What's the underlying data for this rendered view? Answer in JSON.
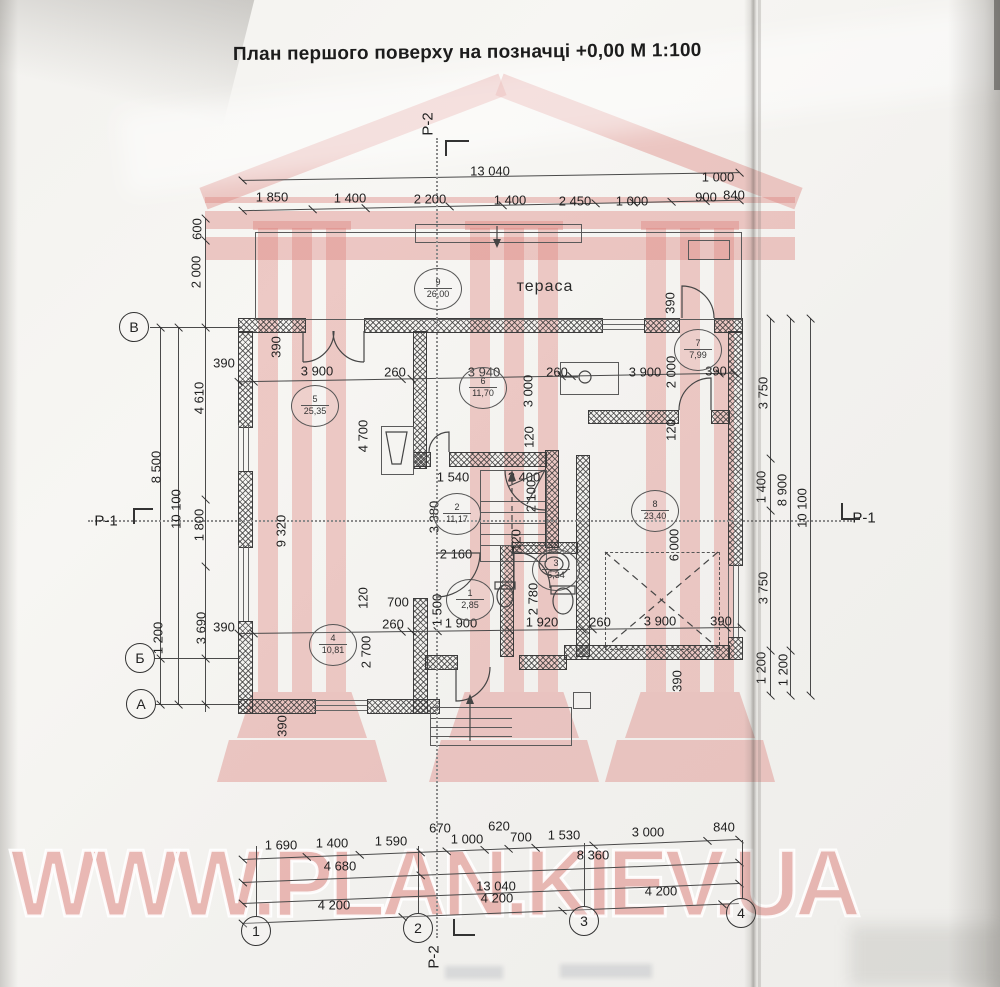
{
  "title": "План першого поверху на позначці +0,00 М 1:100",
  "watermark": {
    "text": "WWW.PLAN.KIEV.UA",
    "color": "#dd8a84"
  },
  "plan": {
    "terrace_label": "тераса"
  },
  "axes": {
    "left": [
      {
        "t": "В",
        "x": 134,
        "y": 327
      },
      {
        "t": "Б",
        "x": 140,
        "y": 658
      },
      {
        "t": "А",
        "x": 141,
        "y": 704
      }
    ],
    "bottom": [
      {
        "t": "1",
        "x": 256,
        "y": 931
      },
      {
        "t": "2",
        "x": 418,
        "y": 928
      },
      {
        "t": "3",
        "x": 584,
        "y": 921
      },
      {
        "t": "4",
        "x": 741,
        "y": 913
      }
    ]
  },
  "sections": [
    {
      "t": "Р-2",
      "x": 428,
      "y": 124,
      "r": 1
    },
    {
      "t": "Р-2",
      "x": 434,
      "y": 957,
      "r": 1
    },
    {
      "t": "Р-1",
      "x": 106,
      "y": 521,
      "r": 0
    },
    {
      "t": "Р-1",
      "x": 864,
      "y": 518,
      "r": 0
    }
  ],
  "rooms": [
    {
      "n": "9",
      "a": "26,00",
      "x": 438,
      "y": 289
    },
    {
      "n": "5",
      "a": "25,35",
      "x": 315,
      "y": 406
    },
    {
      "n": "6",
      "a": "11,70",
      "x": 483,
      "y": 388
    },
    {
      "n": "7",
      "a": "7,99",
      "x": 698,
      "y": 350
    },
    {
      "n": "2",
      "a": "11,17",
      "x": 457,
      "y": 514
    },
    {
      "n": "8",
      "a": "23,40",
      "x": 655,
      "y": 511
    },
    {
      "n": "1",
      "a": "2,85",
      "x": 470,
      "y": 600
    },
    {
      "n": "3",
      "a": "5,34",
      "x": 556,
      "y": 570
    },
    {
      "n": "4",
      "a": "10,81",
      "x": 333,
      "y": 645
    }
  ],
  "dims": [
    {
      "t": "13 040",
      "x": 490,
      "y": 171
    },
    {
      "t": "1 000",
      "x": 718,
      "y": 177
    },
    {
      "t": "1 850",
      "x": 272,
      "y": 197
    },
    {
      "t": "1 400",
      "x": 350,
      "y": 198
    },
    {
      "t": "2 200",
      "x": 430,
      "y": 199
    },
    {
      "t": "1 400",
      "x": 510,
      "y": 200
    },
    {
      "t": "2 450",
      "x": 575,
      "y": 201
    },
    {
      "t": "1 000",
      "x": 632,
      "y": 201
    },
    {
      "t": "900",
      "x": 706,
      "y": 197
    },
    {
      "t": "840",
      "x": 734,
      "y": 195
    },
    {
      "t": "600",
      "x": 197,
      "y": 229,
      "r": 1
    },
    {
      "t": "2 000",
      "x": 196,
      "y": 272,
      "r": 1
    },
    {
      "t": "4 610",
      "x": 199,
      "y": 398,
      "r": 1
    },
    {
      "t": "8 500",
      "x": 156,
      "y": 467,
      "r": 1
    },
    {
      "t": "10 100",
      "x": 176,
      "y": 509,
      "r": 1
    },
    {
      "t": "1 800",
      "x": 199,
      "y": 525,
      "r": 1
    },
    {
      "t": "3 690",
      "x": 201,
      "y": 628,
      "r": 1
    },
    {
      "t": "1 200",
      "x": 158,
      "y": 638,
      "r": 1
    },
    {
      "t": "9 320",
      "x": 281,
      "y": 531,
      "r": 1
    },
    {
      "t": "3 750",
      "x": 763,
      "y": 393,
      "r": 1
    },
    {
      "t": "1 400",
      "x": 761,
      "y": 487,
      "r": 1
    },
    {
      "t": "8 900",
      "x": 782,
      "y": 490,
      "r": 1
    },
    {
      "t": "10 100",
      "x": 802,
      "y": 508,
      "r": 1
    },
    {
      "t": "3 750",
      "x": 763,
      "y": 588,
      "r": 1
    },
    {
      "t": "1 200",
      "x": 761,
      "y": 668,
      "r": 1
    },
    {
      "t": "1 200",
      "x": 783,
      "y": 670,
      "r": 1
    },
    {
      "t": "390",
      "x": 224,
      "y": 363
    },
    {
      "t": "3 900",
      "x": 317,
      "y": 371
    },
    {
      "t": "260",
      "x": 395,
      "y": 372
    },
    {
      "t": "3 940",
      "x": 484,
      "y": 372
    },
    {
      "t": "260",
      "x": 557,
      "y": 372
    },
    {
      "t": "3 900",
      "x": 645,
      "y": 372
    },
    {
      "t": "390",
      "x": 716,
      "y": 371
    },
    {
      "t": "390",
      "x": 276,
      "y": 347,
      "r": 1
    },
    {
      "t": "390",
      "x": 670,
      "y": 303,
      "r": 1
    },
    {
      "t": "2 000",
      "x": 671,
      "y": 372,
      "r": 1
    },
    {
      "t": "120",
      "x": 671,
      "y": 430,
      "r": 1
    },
    {
      "t": "3 000",
      "x": 528,
      "y": 391,
      "r": 1
    },
    {
      "t": "120",
      "x": 529,
      "y": 437,
      "r": 1
    },
    {
      "t": "4 700",
      "x": 363,
      "y": 436,
      "r": 1
    },
    {
      "t": "1 540",
      "x": 453,
      "y": 477
    },
    {
      "t": "2 400",
      "x": 524,
      "y": 477
    },
    {
      "t": "2 100",
      "x": 531,
      "y": 496,
      "r": 1
    },
    {
      "t": "3 380",
      "x": 434,
      "y": 517,
      "r": 1
    },
    {
      "t": "2 160",
      "x": 456,
      "y": 554
    },
    {
      "t": "120",
      "x": 516,
      "y": 540,
      "r": 1
    },
    {
      "t": "2 780",
      "x": 533,
      "y": 599,
      "r": 1
    },
    {
      "t": "6 000",
      "x": 674,
      "y": 545,
      "r": 1
    },
    {
      "t": "390",
      "x": 677,
      "y": 681,
      "r": 1
    },
    {
      "t": "700",
      "x": 398,
      "y": 602
    },
    {
      "t": "120",
      "x": 363,
      "y": 598,
      "r": 1
    },
    {
      "t": "260",
      "x": 393,
      "y": 624
    },
    {
      "t": "1 500",
      "x": 437,
      "y": 610,
      "r": 1
    },
    {
      "t": "1 900",
      "x": 461,
      "y": 623
    },
    {
      "t": "1 920",
      "x": 542,
      "y": 622
    },
    {
      "t": "260",
      "x": 600,
      "y": 622
    },
    {
      "t": "3 900",
      "x": 660,
      "y": 621
    },
    {
      "t": "390",
      "x": 721,
      "y": 621
    },
    {
      "t": "2 700",
      "x": 366,
      "y": 652,
      "r": 1
    },
    {
      "t": "390",
      "x": 282,
      "y": 726,
      "r": 1
    },
    {
      "t": "390",
      "x": 224,
      "y": 627
    },
    {
      "t": "670",
      "x": 440,
      "y": 828
    },
    {
      "t": "620",
      "x": 499,
      "y": 826
    },
    {
      "t": "1 690",
      "x": 281,
      "y": 845
    },
    {
      "t": "1 400",
      "x": 332,
      "y": 843
    },
    {
      "t": "1 590",
      "x": 391,
      "y": 841
    },
    {
      "t": "1 000",
      "x": 467,
      "y": 839
    },
    {
      "t": "700",
      "x": 521,
      "y": 837
    },
    {
      "t": "1 530",
      "x": 564,
      "y": 835
    },
    {
      "t": "3 000",
      "x": 648,
      "y": 832
    },
    {
      "t": "840",
      "x": 724,
      "y": 827
    },
    {
      "t": "4 680",
      "x": 340,
      "y": 866
    },
    {
      "t": "8 360",
      "x": 593,
      "y": 855
    },
    {
      "t": "13 040",
      "x": 496,
      "y": 886
    },
    {
      "t": "4 200",
      "x": 334,
      "y": 905
    },
    {
      "t": "4 200",
      "x": 497,
      "y": 898
    },
    {
      "t": "4 200",
      "x": 661,
      "y": 891
    }
  ]
}
